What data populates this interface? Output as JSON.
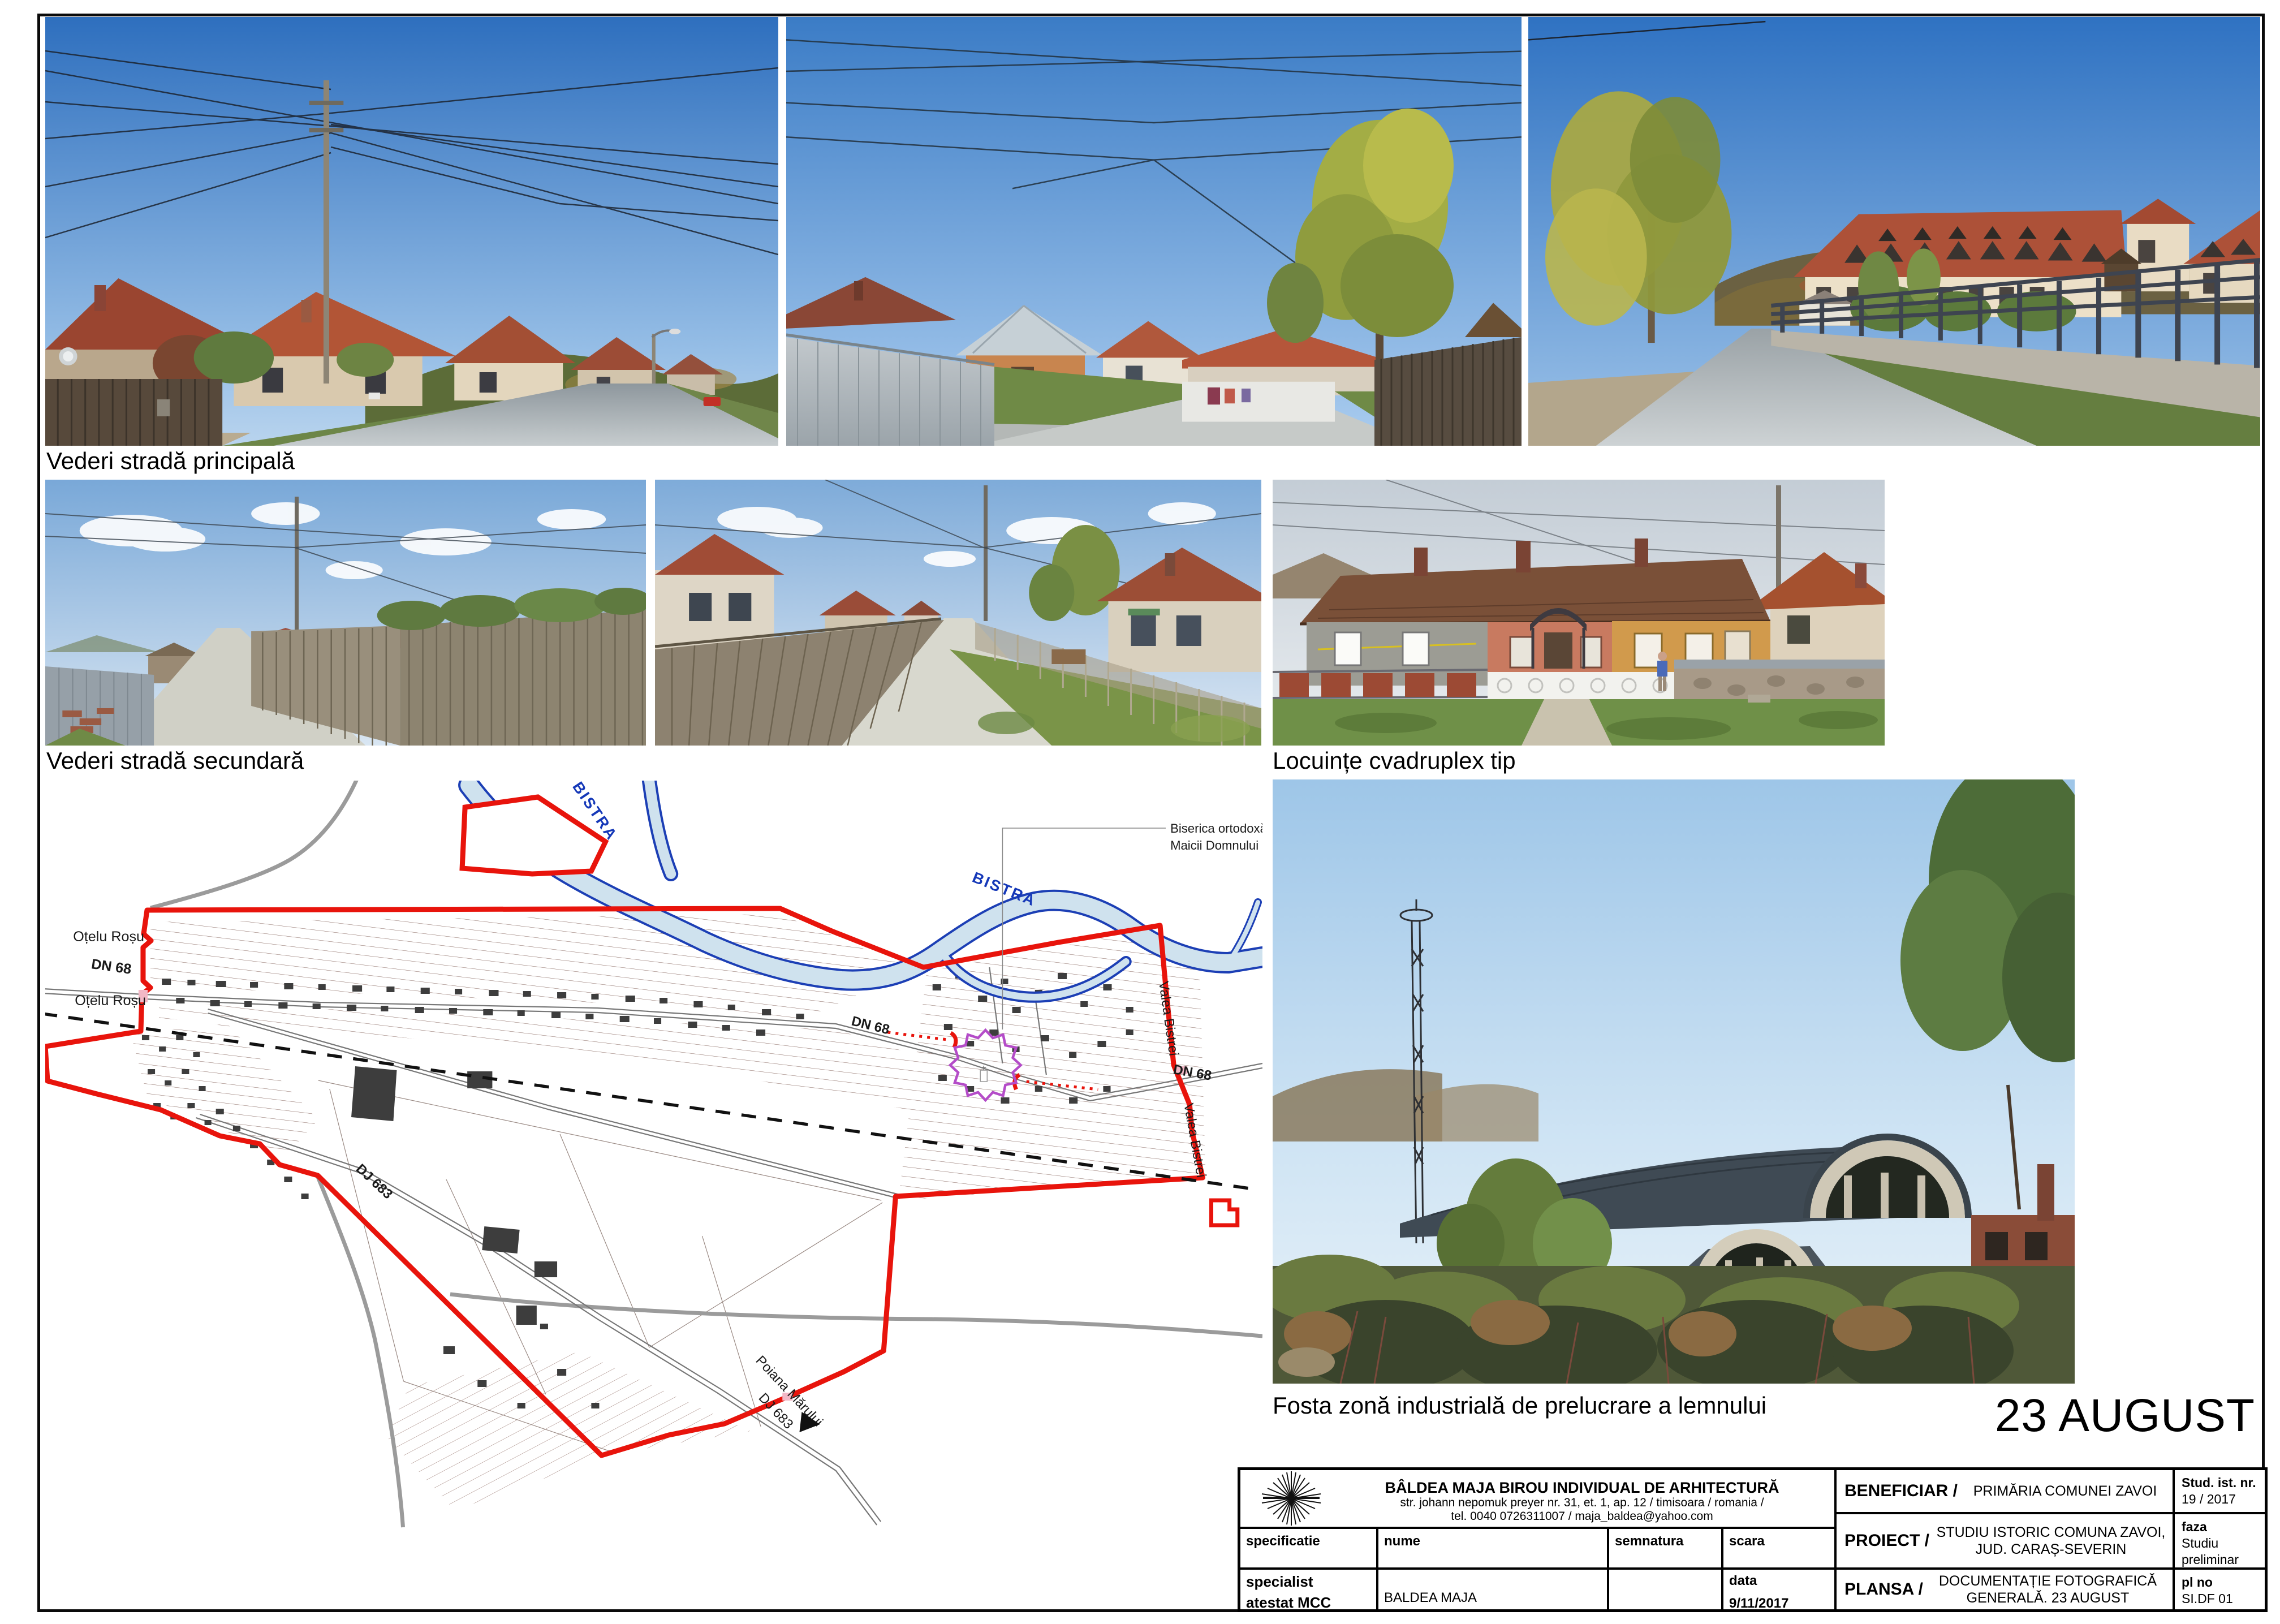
{
  "captions": {
    "main_street": "Vederi stradă principală",
    "secondary_street": "Vederi stradă secundară",
    "quadruplex": "Locuințe cvadruplex tip",
    "industrial": "Fosta zonă industrială de prelucrare a lemnului"
  },
  "big_title": "23 AUGUST",
  "map": {
    "labels": {
      "river_upper": "BISTRA",
      "river_lower": "BISTRA",
      "church_line1": "Biserica ortodoxă Adormirea",
      "church_line2": "Maicii Domnului (1936)",
      "otelu_rosu_top": "Oțelu Roșu",
      "otelu_rosu_bottom": "Oțelu Roșu",
      "dn68_west": "DN 68",
      "dn68_mid": "DN 68",
      "dn68_east": "DN 68",
      "dj683_west": "DJ 683",
      "dj683_south": "DJ 683",
      "valea_bistrei_north": "Valea Bistrei",
      "valea_bistrei_south": "Valea Bistrei",
      "poiana_marului": "Poiana Mărului"
    },
    "colors": {
      "boundary_red": "#e8140c",
      "river_blue": "#1c3fb5",
      "river_fill": "#cfe2ee",
      "marker_purple": "#b44cc8",
      "road_gray": "#9b9b9b",
      "building_dark": "#3d3d3d"
    }
  },
  "titleblock": {
    "office_name": "BÂLDEA MAJA BIROU INDIVIDUAL DE ARHITECTURĂ",
    "office_address": "str. johann nepomuk preyer nr. 31, et. 1, ap. 12 / timisoara / romania /",
    "office_contact": "tel.  0040 0726311007 / maja_baldea@yahoo.com",
    "col_specification": "specificatie",
    "col_name": "nume",
    "col_signature": "semnatura",
    "col_scale": "scara",
    "specialist_line1": "specialist",
    "specialist_line2": "atestat MCC",
    "specialist_name": "BALDEA MAJA",
    "date_label": "data",
    "date_value": "9/11/2017",
    "beneficiar_label": "BENEFICIAR /",
    "beneficiar_value": "PRIMĂRIA COMUNEI ZAVOI",
    "stud_label": "Stud. ist. nr.",
    "stud_value": "19 / 2017",
    "proiect_label": "PROIECT /",
    "proiect_value_l1": "STUDIU ISTORIC COMUNA ZAVOI,",
    "proiect_value_l2": "JUD. CARAȘ-SEVERIN",
    "faza_label": "faza",
    "faza_value_l1": "Studiu",
    "faza_value_l2": "preliminar PUG",
    "plansa_label": "PLANSA /",
    "plansa_value_l1": "DOCUMENTAȚIE FOTOGRAFICĂ",
    "plansa_value_l2": "GENERALĂ. 23 AUGUST",
    "plno_label": "pl no",
    "plno_value": "SI.DF 01"
  }
}
